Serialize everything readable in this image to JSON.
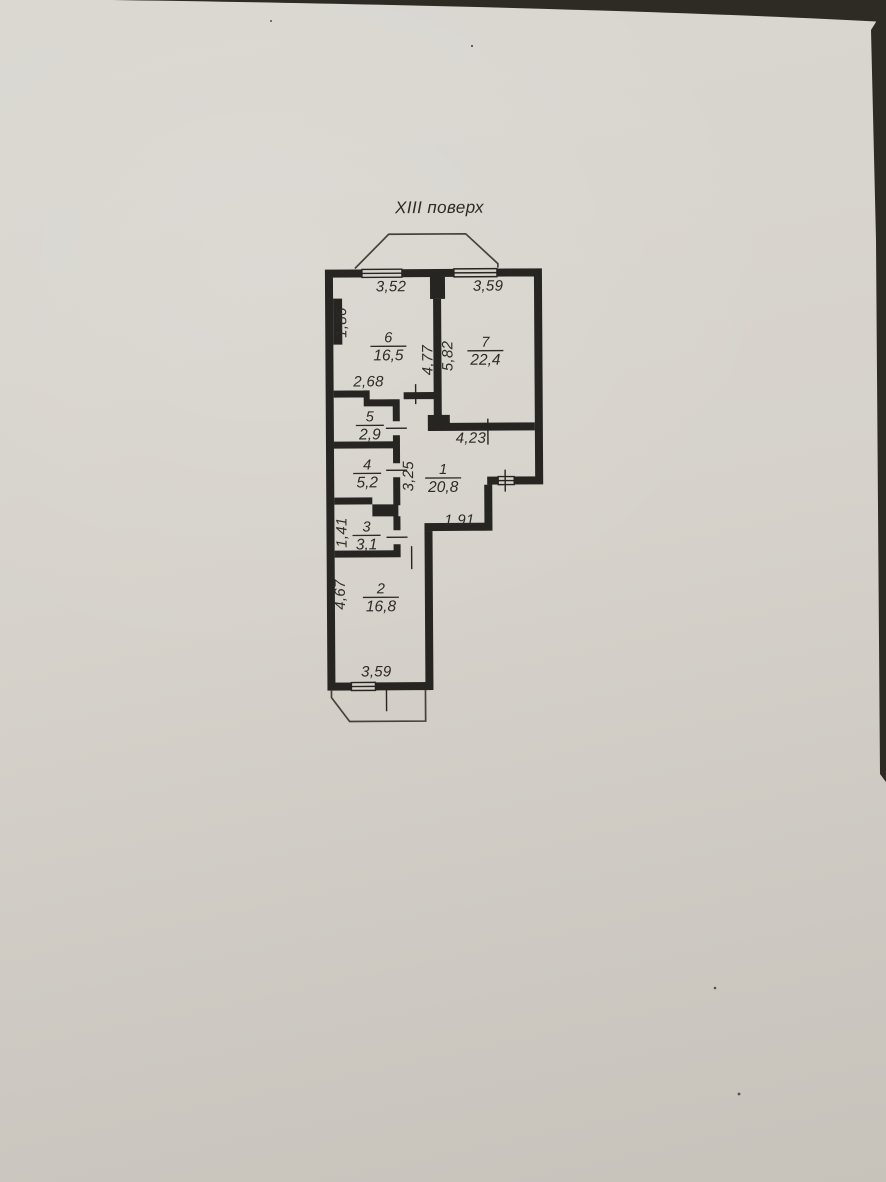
{
  "title": "XIII поверх",
  "rooms": [
    {
      "number": "1",
      "area": "20,8"
    },
    {
      "number": "2",
      "area": "16,8"
    },
    {
      "number": "3",
      "area": "3,1"
    },
    {
      "number": "4",
      "area": "5,2"
    },
    {
      "number": "5",
      "area": "2,9"
    },
    {
      "number": "6",
      "area": "16,5"
    },
    {
      "number": "7",
      "area": "22,4"
    }
  ],
  "dimensions": {
    "top_left_width": "3,52",
    "top_right_width": "3,59",
    "room6_left_height": "1,86",
    "room6_right_height": "4,77",
    "room7_left_height": "5,82",
    "room6_bottom_width": "2,68",
    "hall_top_width": "4,23",
    "hall_width": "3,25",
    "hall_bottom_width": "1,91",
    "room3_left_height": "1,41",
    "room2_left_height": "4,67",
    "room2_bottom_width": "3,59"
  },
  "colors": {
    "paper": "#d7d3cc",
    "ink": "#262521"
  }
}
